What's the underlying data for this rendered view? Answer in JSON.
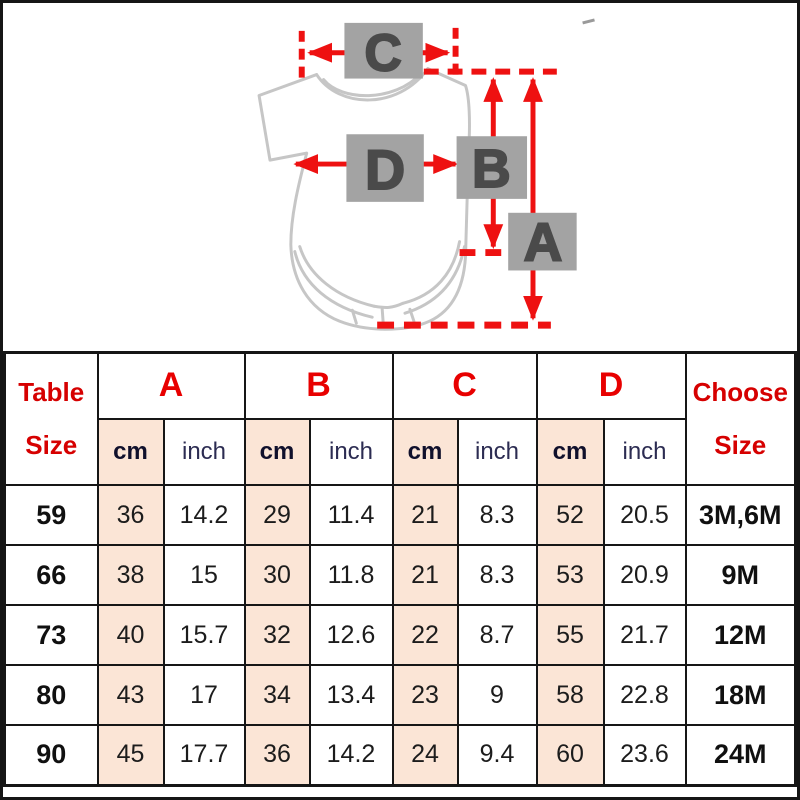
{
  "colors": {
    "accent_red": "#ee1111",
    "header_red": "#d60000",
    "peach_cell": "#fbe5d6",
    "gray_label_box": "#a3a3a3",
    "gray_letter": "#4a4a4a",
    "garment_outline": "#c6c6c6",
    "grid_border": "#161616"
  },
  "diagram": {
    "measure_labels": [
      "C",
      "D",
      "B",
      "A"
    ]
  },
  "chart_data": {
    "type": "table",
    "title": "Baby bodysuit size chart with measurement diagram (A length, B body length, C shoulder width, D chest width)",
    "corner_header": {
      "line1": "Table",
      "line2": "Size"
    },
    "choose_header": {
      "line1": "Choose",
      "line2": "Size"
    },
    "measure_groups": [
      "A",
      "B",
      "C",
      "D"
    ],
    "unit_labels": [
      "cm",
      "inch"
    ],
    "rows": [
      {
        "size": "59",
        "values": [
          "36",
          "14.2",
          "29",
          "11.4",
          "21",
          "8.3",
          "52",
          "20.5"
        ],
        "choose": "3M,6M"
      },
      {
        "size": "66",
        "values": [
          "38",
          "15",
          "30",
          "11.8",
          "21",
          "8.3",
          "53",
          "20.9"
        ],
        "choose": "9M"
      },
      {
        "size": "73",
        "values": [
          "40",
          "15.7",
          "32",
          "12.6",
          "22",
          "8.7",
          "55",
          "21.7"
        ],
        "choose": "12M"
      },
      {
        "size": "80",
        "values": [
          "43",
          "17",
          "34",
          "13.4",
          "23",
          "9",
          "58",
          "22.8"
        ],
        "choose": "18M"
      },
      {
        "size": "90",
        "values": [
          "45",
          "17.7",
          "36",
          "14.2",
          "24",
          "9.4",
          "60",
          "23.6"
        ],
        "choose": "24M"
      }
    ]
  }
}
